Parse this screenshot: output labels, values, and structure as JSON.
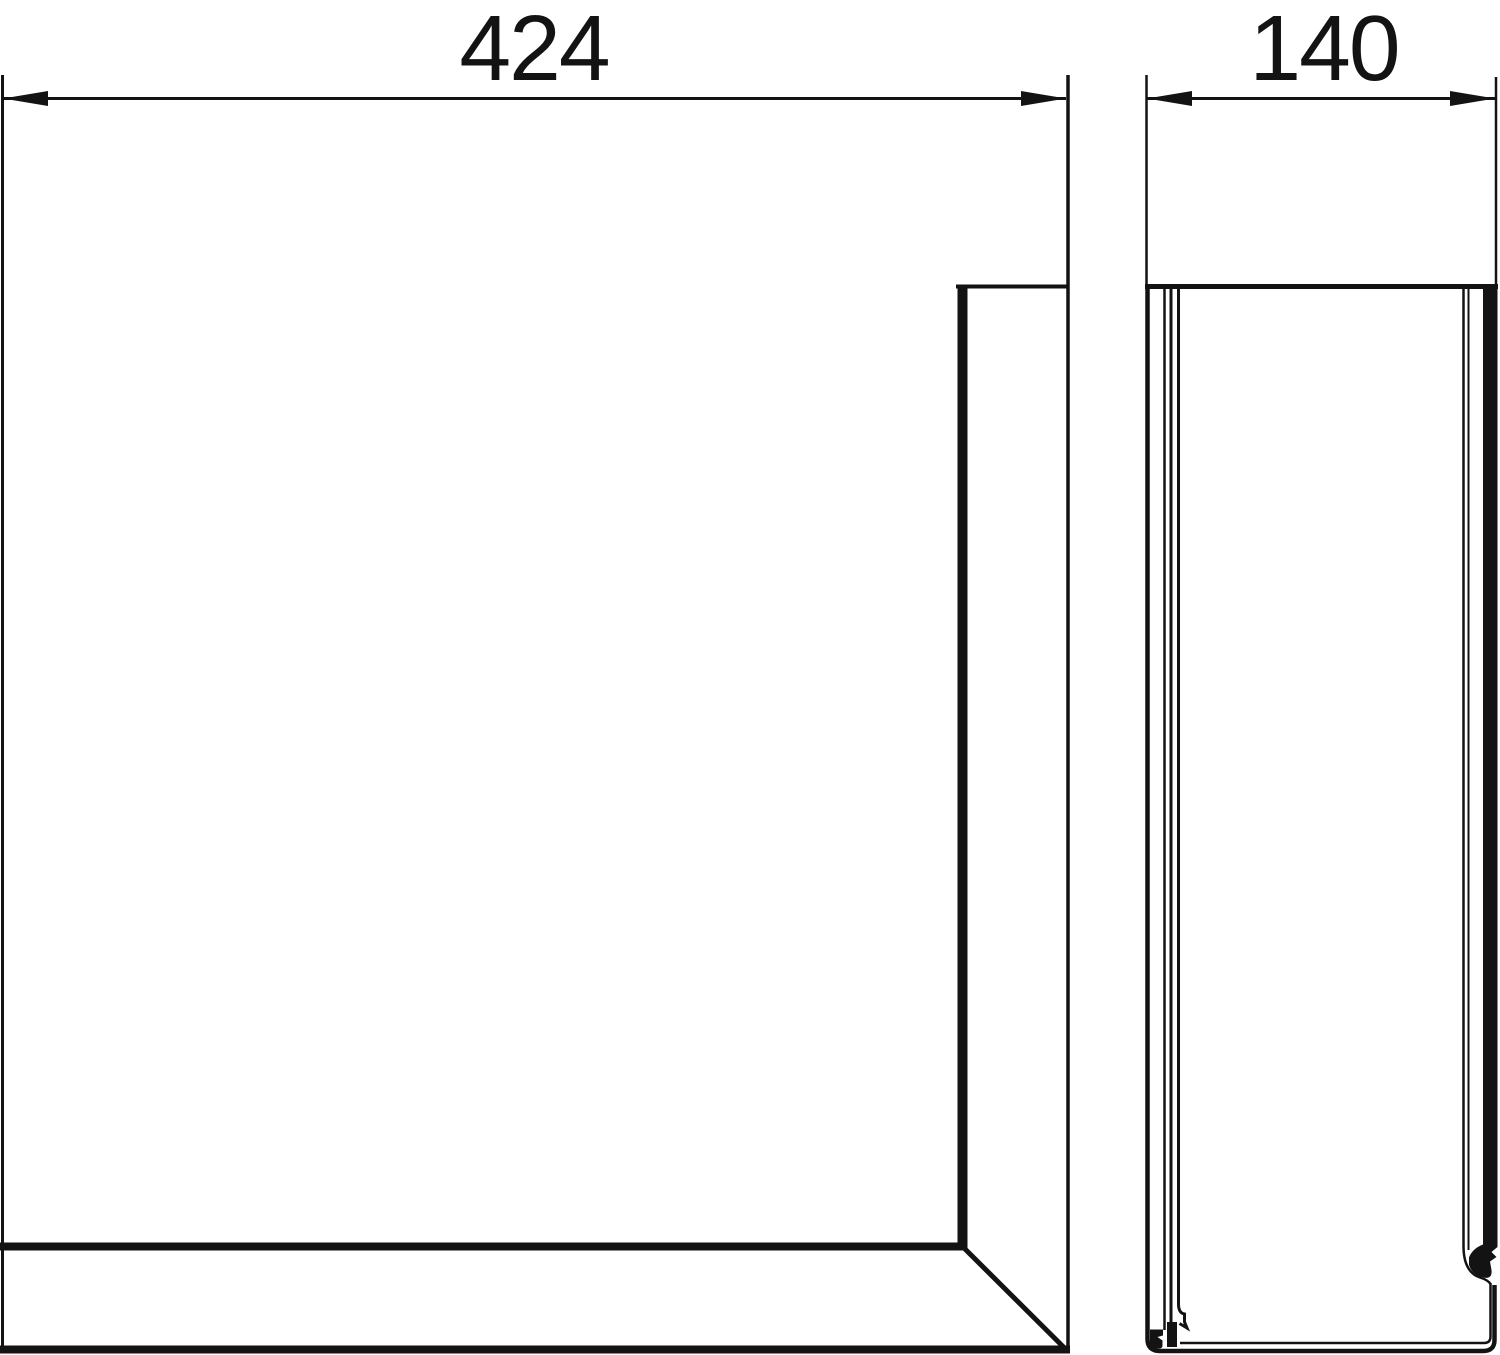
{
  "colors": {
    "background": "#ffffff",
    "line": "#131313"
  },
  "dimensions": {
    "front_width": {
      "label": "424"
    },
    "side_depth": {
      "label": "140"
    }
  }
}
